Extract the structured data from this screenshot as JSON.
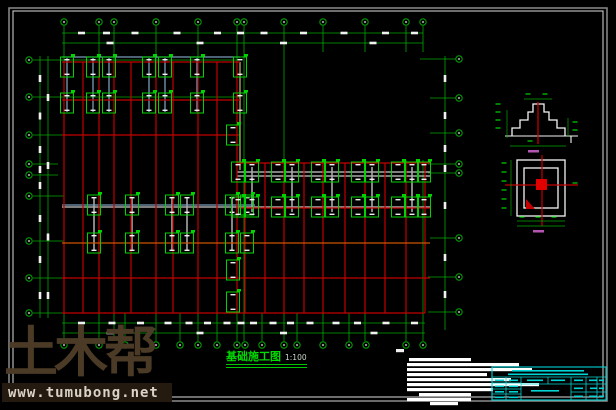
{
  "drawing": {
    "plan_title": "基础施工图",
    "plan_scale": "1:100",
    "colors": {
      "background": "#000000",
      "grid_green": "#00a800",
      "bright_green": "#00d400",
      "beam_red": "#c40000",
      "beam_orange": "#cc5500",
      "beam_tan": "#b09a60",
      "beam_gray": "#a8a8a8",
      "beam_cyan": "#7a9cba",
      "dim_white": "#f0f0f0",
      "titleblock_cyan": "#00d4d4",
      "detail_white": "#f5f5f5",
      "label_magenta": "#b455b4",
      "frame_outer": "#8c8c8c",
      "frame_inner": "#dcdcdc"
    }
  },
  "watermark": {
    "logo_text": "土木帮",
    "url": "www.tumubong.net"
  },
  "geometry": {
    "frame": {
      "outer": [
        9,
        8,
        598,
        393
      ],
      "inner": [
        13,
        11,
        590,
        386
      ]
    },
    "grid": {
      "top_bubbles": {
        "y": 22,
        "x": [
          64,
          99,
          114,
          156,
          198,
          237,
          244,
          284,
          323,
          365,
          406,
          423
        ]
      },
      "bottom_bubbles": {
        "y": 345,
        "x": [
          64,
          99,
          125,
          156,
          180,
          198,
          217,
          237,
          245,
          262,
          284,
          297,
          323,
          349,
          366,
          406,
          423
        ]
      },
      "left_bubbles": {
        "x": 29,
        "y": [
          60,
          97,
          135,
          164,
          175,
          196,
          241,
          278,
          313
        ]
      },
      "right_bubbles": {
        "x": 459,
        "y": [
          59,
          98,
          133,
          164,
          173,
          238,
          277,
          312
        ]
      },
      "v_lines": [
        [
          64,
          26,
          341
        ],
        [
          99,
          26,
          341
        ],
        [
          114,
          26,
          341
        ],
        [
          156,
          26,
          341
        ],
        [
          198,
          26,
          341
        ],
        [
          237,
          26,
          341
        ],
        [
          244,
          26,
          341
        ],
        [
          284,
          26,
          341
        ],
        [
          323,
          26,
          52
        ],
        [
          365,
          26,
          52
        ],
        [
          406,
          26,
          52
        ],
        [
          423,
          26,
          52
        ],
        [
          323,
          160,
          341
        ],
        [
          365,
          160,
          341
        ],
        [
          406,
          160,
          341
        ],
        [
          423,
          160,
          341
        ],
        [
          125,
          313,
          341
        ],
        [
          180,
          313,
          341
        ],
        [
          217,
          313,
          341
        ],
        [
          262,
          313,
          341
        ],
        [
          297,
          313,
          341
        ],
        [
          349,
          313,
          341
        ]
      ],
      "h_lines": [
        [
          60,
          33,
          240
        ],
        [
          97,
          33,
          240
        ],
        [
          135,
          33,
          240
        ],
        [
          164,
          33,
          58
        ],
        [
          175,
          33,
          58
        ],
        [
          196,
          33,
          64
        ],
        [
          241,
          33,
          64
        ],
        [
          278,
          33,
          64
        ],
        [
          313,
          33,
          64
        ],
        [
          59,
          420,
          456
        ],
        [
          98,
          430,
          456
        ],
        [
          133,
          430,
          456
        ],
        [
          164,
          428,
          456
        ],
        [
          173,
          428,
          456
        ],
        [
          238,
          430,
          456
        ],
        [
          277,
          428,
          456
        ],
        [
          312,
          428,
          456
        ]
      ]
    },
    "dims": {
      "lines": [
        [
          62,
          33,
          423,
          33
        ],
        [
          62,
          43,
          423,
          43
        ],
        [
          40,
          56,
          40,
          318
        ],
        [
          48,
          56,
          48,
          318
        ],
        [
          62,
          323,
          425,
          323
        ],
        [
          62,
          333,
          425,
          333
        ],
        [
          445,
          56,
          445,
          330
        ]
      ],
      "blob_w": 7,
      "blob_h": 2.6,
      "major_top": [
        64,
        156,
        244,
        323,
        423
      ],
      "major_left": [
        60,
        135,
        196,
        278,
        313
      ],
      "major_bottom": [
        64,
        156,
        244,
        323,
        425
      ]
    },
    "beams": {
      "red_v": [
        [
          64,
          62,
          313
        ],
        [
          83,
          62,
          313
        ],
        [
          99,
          62,
          313
        ],
        [
          114,
          62,
          313
        ],
        [
          131,
          62,
          313
        ],
        [
          156,
          62,
          313
        ],
        [
          173,
          62,
          313
        ],
        [
          198,
          62,
          313
        ],
        [
          217,
          62,
          313
        ],
        [
          237,
          62,
          313
        ],
        [
          245,
          163,
          313
        ],
        [
          265,
          163,
          313
        ],
        [
          284,
          163,
          313
        ],
        [
          304,
          163,
          313
        ],
        [
          323,
          163,
          313
        ],
        [
          345,
          163,
          313
        ],
        [
          365,
          163,
          313
        ],
        [
          385,
          163,
          313
        ],
        [
          406,
          163,
          313
        ],
        [
          425,
          163,
          313
        ]
      ],
      "red_h": [
        [
          62,
          62,
          240
        ],
        [
          100,
          62,
          240
        ],
        [
          135,
          62,
          240
        ],
        [
          163,
          237,
          430
        ],
        [
          208,
          237,
          430
        ],
        [
          278,
          62,
          430
        ],
        [
          313,
          62,
          425
        ]
      ],
      "orange_h": [
        [
          243,
          62,
          430
        ]
      ],
      "tan_v": [
        [
          240,
          62,
          170
        ]
      ],
      "gray_h": [
        [
          172,
          237,
          430
        ],
        [
          176,
          237,
          430
        ],
        [
          207,
          62,
          430
        ]
      ],
      "gray_v": [
        [
          252,
          167,
          212
        ],
        [
          292,
          167,
          212
        ],
        [
          332,
          167,
          212
        ],
        [
          372,
          167,
          212
        ],
        [
          412,
          167,
          212
        ],
        [
          94,
          198,
          250
        ],
        [
          132,
          198,
          250
        ],
        [
          172,
          198,
          250
        ],
        [
          187,
          198,
          250
        ],
        [
          232,
          198,
          250
        ]
      ],
      "cyan_v": [
        [
          67,
          58,
          112
        ],
        [
          93,
          58,
          112
        ],
        [
          109,
          58,
          112
        ],
        [
          149,
          58,
          112
        ],
        [
          165,
          58,
          112
        ],
        [
          197,
          58,
          112
        ]
      ],
      "cyan_h": [
        [
          57,
          62,
          240
        ],
        [
          205,
          62,
          255
        ]
      ]
    },
    "caps": {
      "w": 13,
      "h": 20,
      "centers": [
        [
          67,
          67
        ],
        [
          93,
          67
        ],
        [
          109,
          67
        ],
        [
          149,
          67
        ],
        [
          165,
          67
        ],
        [
          197,
          67
        ],
        [
          240,
          67
        ],
        [
          67,
          103
        ],
        [
          93,
          103
        ],
        [
          109,
          103
        ],
        [
          149,
          103
        ],
        [
          165,
          103
        ],
        [
          197,
          103
        ],
        [
          240,
          103
        ],
        [
          94,
          205
        ],
        [
          132,
          205
        ],
        [
          172,
          205
        ],
        [
          187,
          205
        ],
        [
          232,
          205
        ],
        [
          247,
          205
        ],
        [
          94,
          243
        ],
        [
          132,
          243
        ],
        [
          172,
          243
        ],
        [
          187,
          243
        ],
        [
          232,
          243
        ],
        [
          247,
          243
        ],
        [
          238,
          172
        ],
        [
          252,
          172
        ],
        [
          278,
          172
        ],
        [
          292,
          172
        ],
        [
          318,
          172
        ],
        [
          332,
          172
        ],
        [
          358,
          172
        ],
        [
          372,
          172
        ],
        [
          398,
          172
        ],
        [
          412,
          172
        ],
        [
          424,
          172
        ],
        [
          238,
          207
        ],
        [
          252,
          207
        ],
        [
          278,
          207
        ],
        [
          292,
          207
        ],
        [
          318,
          207
        ],
        [
          332,
          207
        ],
        [
          358,
          207
        ],
        [
          372,
          207
        ],
        [
          398,
          207
        ],
        [
          412,
          207
        ],
        [
          424,
          207
        ],
        [
          233,
          135
        ],
        [
          233,
          270
        ],
        [
          233,
          302
        ]
      ]
    },
    "section_detail": {
      "steps_path": "M512,136 L512,128 L520,128 L520,120 L528,120 L528,112 L533,112 L533,104 L544,104 L544,112 L549,112 L549,120 L557,120 L557,128 L565,128 L565,136",
      "ground_line": [
        505,
        136,
        578,
        136
      ],
      "hook": [
        571,
        136,
        571,
        143
      ],
      "centerline": [
        538,
        102,
        538,
        144
      ],
      "green_dims": [
        [
          507,
          110,
          507,
          138
        ],
        [
          524,
          99,
          552,
          99
        ],
        [
          568,
          118,
          568,
          137
        ],
        [
          510,
          146,
          566,
          146
        ]
      ],
      "green_marks": [
        [
          498,
          104
        ],
        [
          498,
          112
        ],
        [
          498,
          120
        ],
        [
          498,
          128
        ],
        [
          528,
          94
        ],
        [
          545,
          94
        ],
        [
          575,
          122
        ],
        [
          575,
          130
        ],
        [
          530,
          141
        ]
      ],
      "label_blob": [
        528,
        150,
        11
      ]
    },
    "plan_detail": {
      "rects": [
        [
          517,
          160,
          48,
          56
        ],
        [
          524,
          168,
          34,
          40
        ]
      ],
      "red_square": [
        536,
        179,
        11,
        11
      ],
      "cross_v": [
        542,
        155,
        542,
        226
      ],
      "cross_h": [
        505,
        185,
        578,
        185
      ],
      "triangle": "M526,209 L526,199 L535,209 Z",
      "green_dims": [
        [
          511,
          160,
          511,
          216
        ],
        [
          517,
          221,
          565,
          221
        ],
        [
          517,
          226,
          565,
          226
        ]
      ],
      "green_marks": [
        [
          504,
          163
        ],
        [
          504,
          172
        ],
        [
          504,
          181
        ],
        [
          504,
          190
        ],
        [
          504,
          199
        ],
        [
          504,
          208
        ],
        [
          522,
          217
        ],
        [
          538,
          217
        ],
        [
          554,
          217
        ],
        [
          575,
          183
        ]
      ],
      "label_blob": [
        533,
        230,
        11
      ]
    },
    "notes": {
      "mark": [
        396,
        349
      ],
      "lines": [
        [
          409,
          358,
          62
        ],
        [
          407,
          363,
          112
        ],
        [
          407,
          368,
          125
        ],
        [
          407,
          373,
          80
        ],
        [
          407,
          378,
          104
        ],
        [
          407,
          383,
          132
        ],
        [
          407,
          388,
          86
        ],
        [
          419,
          393,
          52
        ],
        [
          407,
          398,
          64
        ],
        [
          430,
          402,
          28
        ]
      ]
    },
    "title_block": {
      "outer": [
        492,
        367,
        114,
        33
      ],
      "h_lines": [
        [
          377,
          492,
          606
        ],
        [
          383,
          492,
          521
        ],
        [
          389,
          492,
          521
        ],
        [
          394,
          492,
          521
        ],
        [
          384,
          521,
          571
        ],
        [
          384,
          571,
          606
        ],
        [
          392,
          571,
          606
        ]
      ],
      "v_lines": [
        [
          506,
          377,
          400
        ],
        [
          521,
          377,
          400
        ],
        [
          548,
          377,
          384
        ],
        [
          571,
          377,
          400
        ],
        [
          586,
          377,
          400
        ],
        [
          597,
          377,
          400
        ]
      ],
      "blobs": [
        [
          512,
          370,
          72
        ],
        [
          508,
          373.5,
          80
        ],
        [
          495,
          379.5,
          9
        ],
        [
          509,
          379.5,
          9
        ],
        [
          495,
          385.5,
          9
        ],
        [
          509,
          385.5,
          9
        ],
        [
          495,
          391,
          9
        ],
        [
          509,
          391,
          9
        ],
        [
          495,
          396.5,
          9
        ],
        [
          509,
          396.5,
          9
        ],
        [
          527,
          379.5,
          16
        ],
        [
          551,
          379.5,
          14
        ],
        [
          531,
          390,
          28
        ],
        [
          574,
          379.5,
          9
        ],
        [
          589,
          379.5,
          8
        ],
        [
          574,
          387.5,
          9
        ],
        [
          590,
          387.5,
          7
        ],
        [
          574,
          395.5,
          9
        ],
        [
          589,
          395.5,
          8
        ],
        [
          599,
          379.5,
          5
        ],
        [
          599,
          387.5,
          5
        ],
        [
          599,
          395.5,
          5
        ]
      ]
    }
  }
}
